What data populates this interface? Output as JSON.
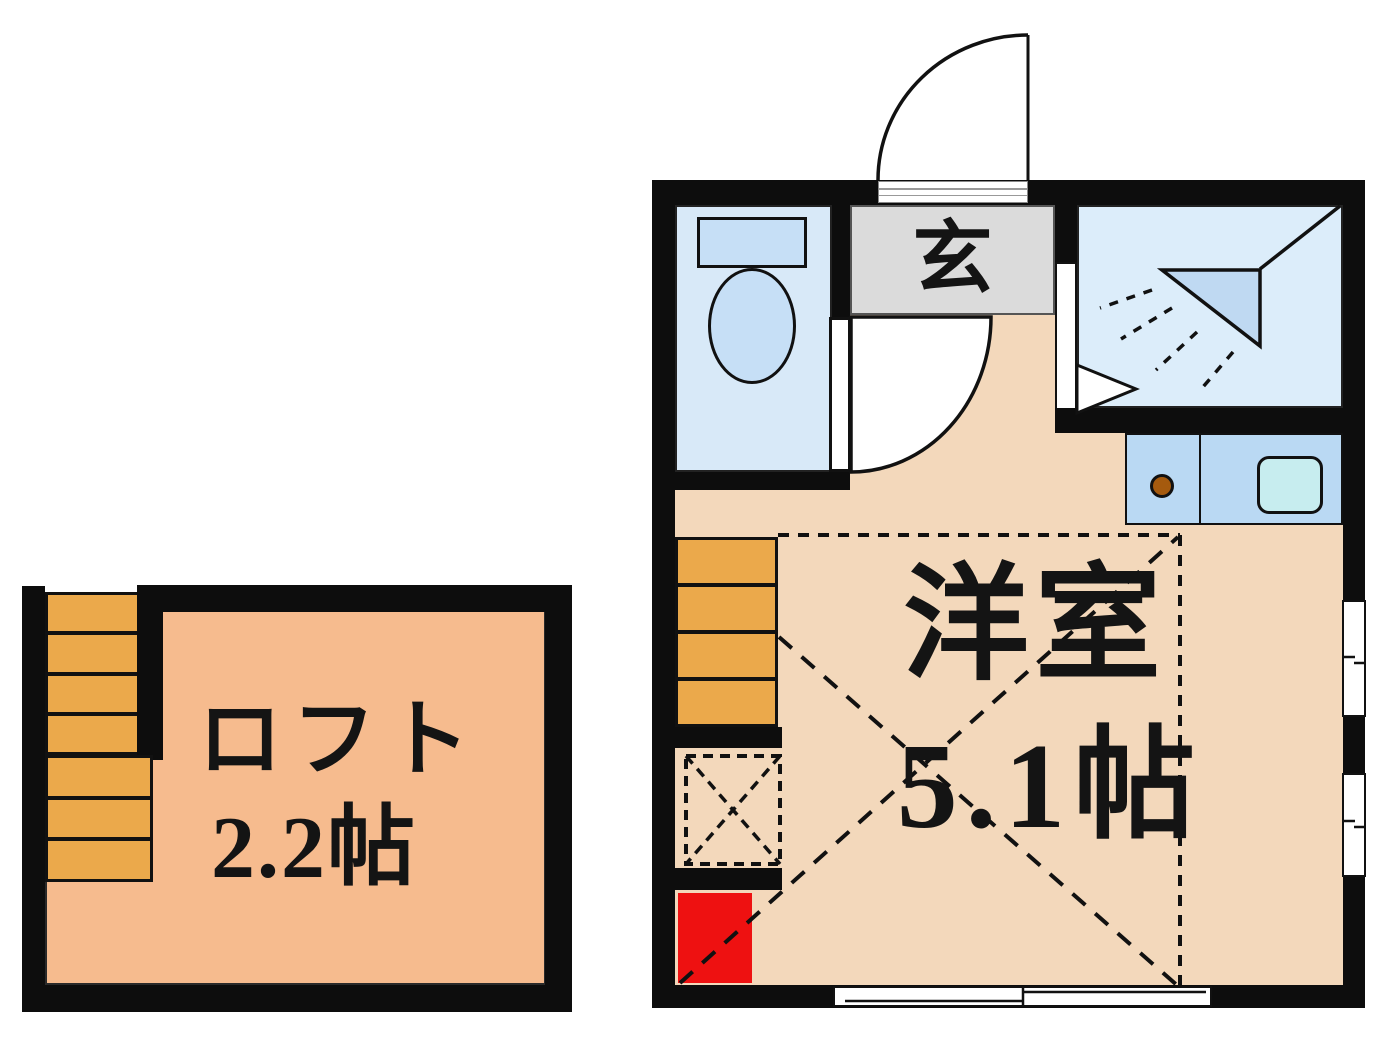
{
  "floorplan": {
    "rooms": [
      {
        "id": "genkan",
        "label": "玄"
      },
      {
        "id": "western-room",
        "label": "洋室",
        "size": "5.1帖"
      },
      {
        "id": "loft",
        "label": "ロフト",
        "size": "2.2帖"
      }
    ],
    "icons": [
      "toilet-icon",
      "shower-icon",
      "door-swing-icon",
      "kitchen-counter-icon",
      "sink-icon",
      "burner-icon",
      "stairs-icon",
      "sliding-window-icon",
      "loft-hatch-icon"
    ],
    "colors": {
      "wall": "#0d0d0d",
      "floor-main": "#F3D8BB",
      "floor-loft": "#F6BB8E",
      "stairs": "#EBA94B",
      "shower-room": "#DCEDFA",
      "toilet-room": "#D8E9F8",
      "fixture-blue": "#C6DFF6",
      "kitchen": "#BAD9F3",
      "sink": "#C7EDEF",
      "genkan": "#DBDBDB",
      "accent-red": "#EE1111",
      "burner": "#A55A0E",
      "shower-head": "#BFD9F2"
    }
  }
}
